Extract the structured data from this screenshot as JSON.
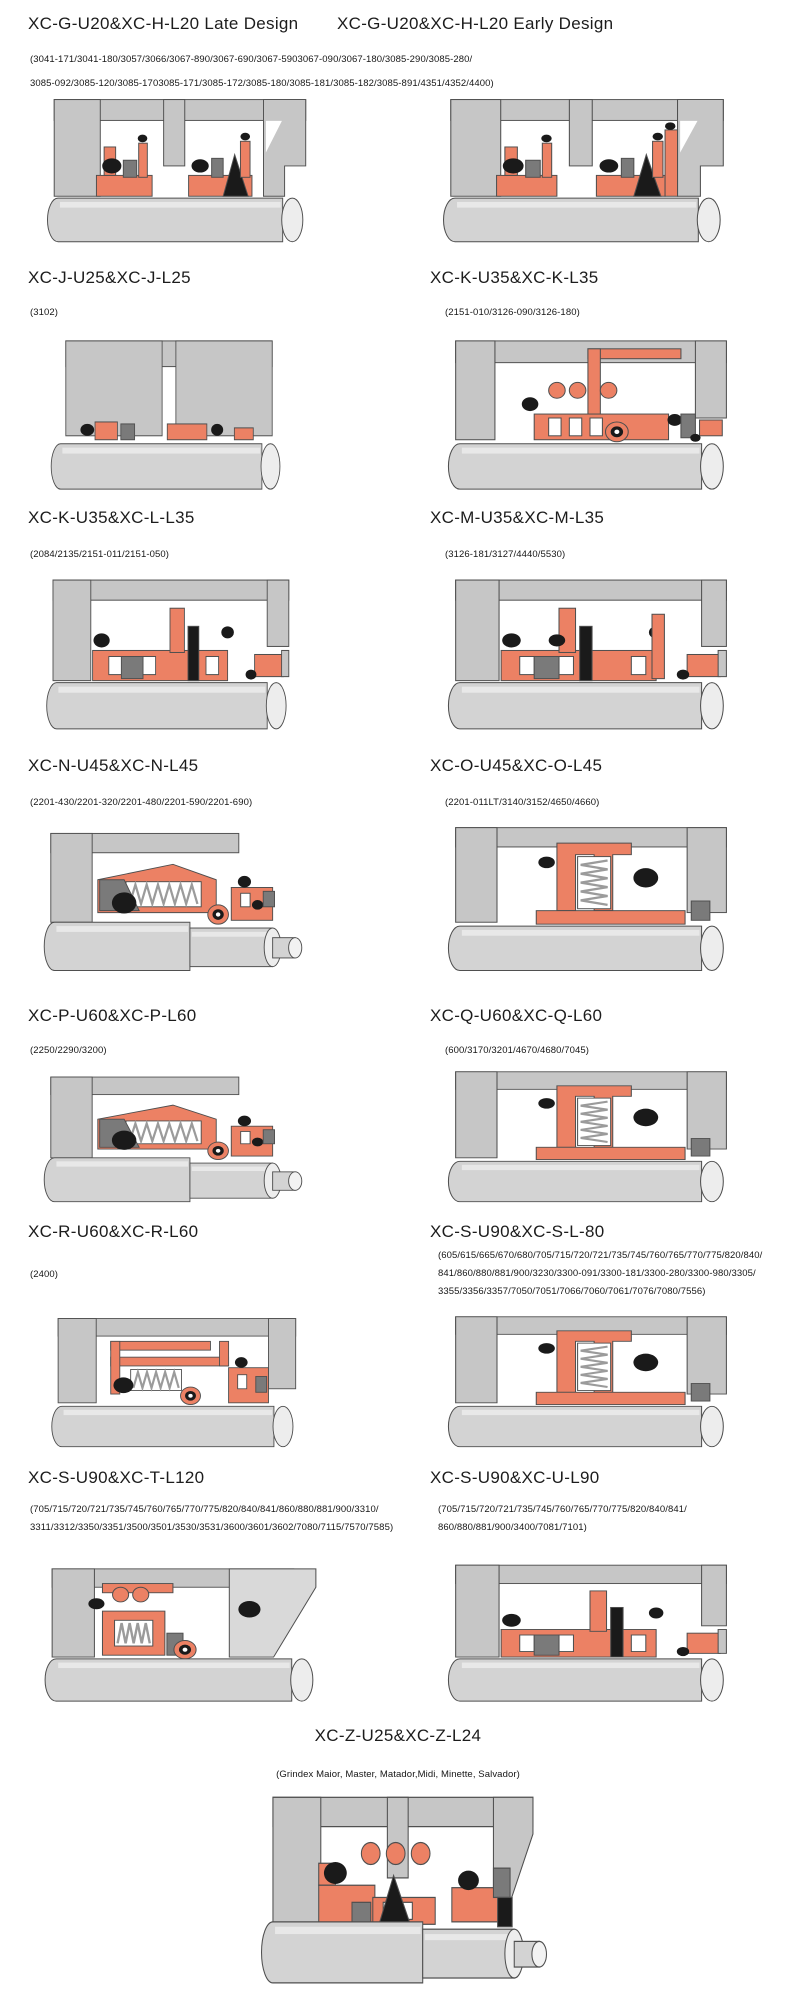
{
  "page": {
    "background": "#ffffff"
  },
  "colors": {
    "housing": "#c6c6c6",
    "housing_light": "#dadada",
    "seal_orange": "#ec8164",
    "dark_gray": "#7a7a7a",
    "black": "#1a1a1a",
    "shaft": "#d3d3d3",
    "shaft_highlight": "#e8e8e8",
    "outline": "#4f4f4f",
    "background": "#ffffff"
  },
  "entries": [
    {
      "title": "XC-G-U20&XC-H-L20 Late Design",
      "parts": [
        "(3041-171/3041-180/3057/3066/3067-890/3067-690/3067-5903067-090/3067-180/3085-290/3085-280/",
        "3085-092/3085-120/3085-1703085-171/3085-172/3085-180/3085-181/3085-182/3085-891/4351/4352/4400)"
      ],
      "diagram": "double-cartridge"
    },
    {
      "title": "XC-G-U20&XC-H-L20 Early Design",
      "parts": [],
      "diagram": "double-cartridge-tall"
    },
    {
      "title": "XC-J-U25&XC-J-L25",
      "parts": [
        "(3102)"
      ],
      "diagram": "plain-housing"
    },
    {
      "title": "XC-K-U35&XC-K-L35",
      "parts": [
        "(2151-010/3126-090/3126-180)"
      ],
      "diagram": "multi-port"
    },
    {
      "title": "XC-K-U35&XC-L-L35",
      "parts": [
        "(2084/2135/2151-011/2151-050)"
      ],
      "diagram": "compact-wide"
    },
    {
      "title": "XC-M-U35&XC-M-L35",
      "parts": [
        "(3126-181/3127/4440/5530)"
      ],
      "diagram": "compact-wide-alt"
    },
    {
      "title": "XC-N-U45&XC-N-L45",
      "parts": [
        "(2201-430/2201-320/2201-480/2201-590/2201-690)"
      ],
      "diagram": "coil-spring-step"
    },
    {
      "title": "XC-O-U45&XC-O-L45",
      "parts": [
        "(2201-011LT/3140/3152/4650/4660)"
      ],
      "diagram": "vertical-spring"
    },
    {
      "title": "XC-P-U60&XC-P-L60",
      "parts": [
        "(2250/2290/3200)"
      ],
      "diagram": "coil-spring-step"
    },
    {
      "title": "XC-Q-U60&XC-Q-L60",
      "parts": [
        "(600/3170/3201/4670/4680/7045)"
      ],
      "diagram": "vertical-spring"
    },
    {
      "title": "XC-R-U60&XC-R-L60",
      "parts": [
        "(2400)"
      ],
      "diagram": "piped-spring"
    },
    {
      "title": "XC-S-U90&XC-S-L-80",
      "parts": [
        "(605/615/665/670/680/705/715/720/721/735/745/760/765/770/775/820/840/",
        "841/860/880/881/900/3230/3300-091/3300-181/3300-280/3300-980/3305/",
        "3355/3356/3357/7050/7051/7066/7060/7061/7076/7080/7556)"
      ],
      "diagram": "vertical-spring"
    },
    {
      "title": "XC-S-U90&XC-T-L120",
      "parts": [
        "(705/715/720/721/735/745/760/765/770/775/820/840/841/860/880/881/900/3310/",
        "3311/3312/3350/3351/3500/3501/3530/3531/3600/3601/3602/7080/7115/7570/7585)"
      ],
      "diagram": "angled-housing"
    },
    {
      "title": "XC-S-U90&XC-U-L90",
      "parts": [
        "(705/715/720/721/735/745/760/765/770/775/820/840/841/",
        "860/880/881/900/3400/7081/7101)"
      ],
      "diagram": "compact-wide"
    },
    {
      "title": "XC-Z-U25&XC-Z-L24",
      "parts": [
        "(Grindex  Maior, Master, Matador,Midi, Minette, Salvador)"
      ],
      "diagram": "double-cartridge-z"
    }
  ]
}
